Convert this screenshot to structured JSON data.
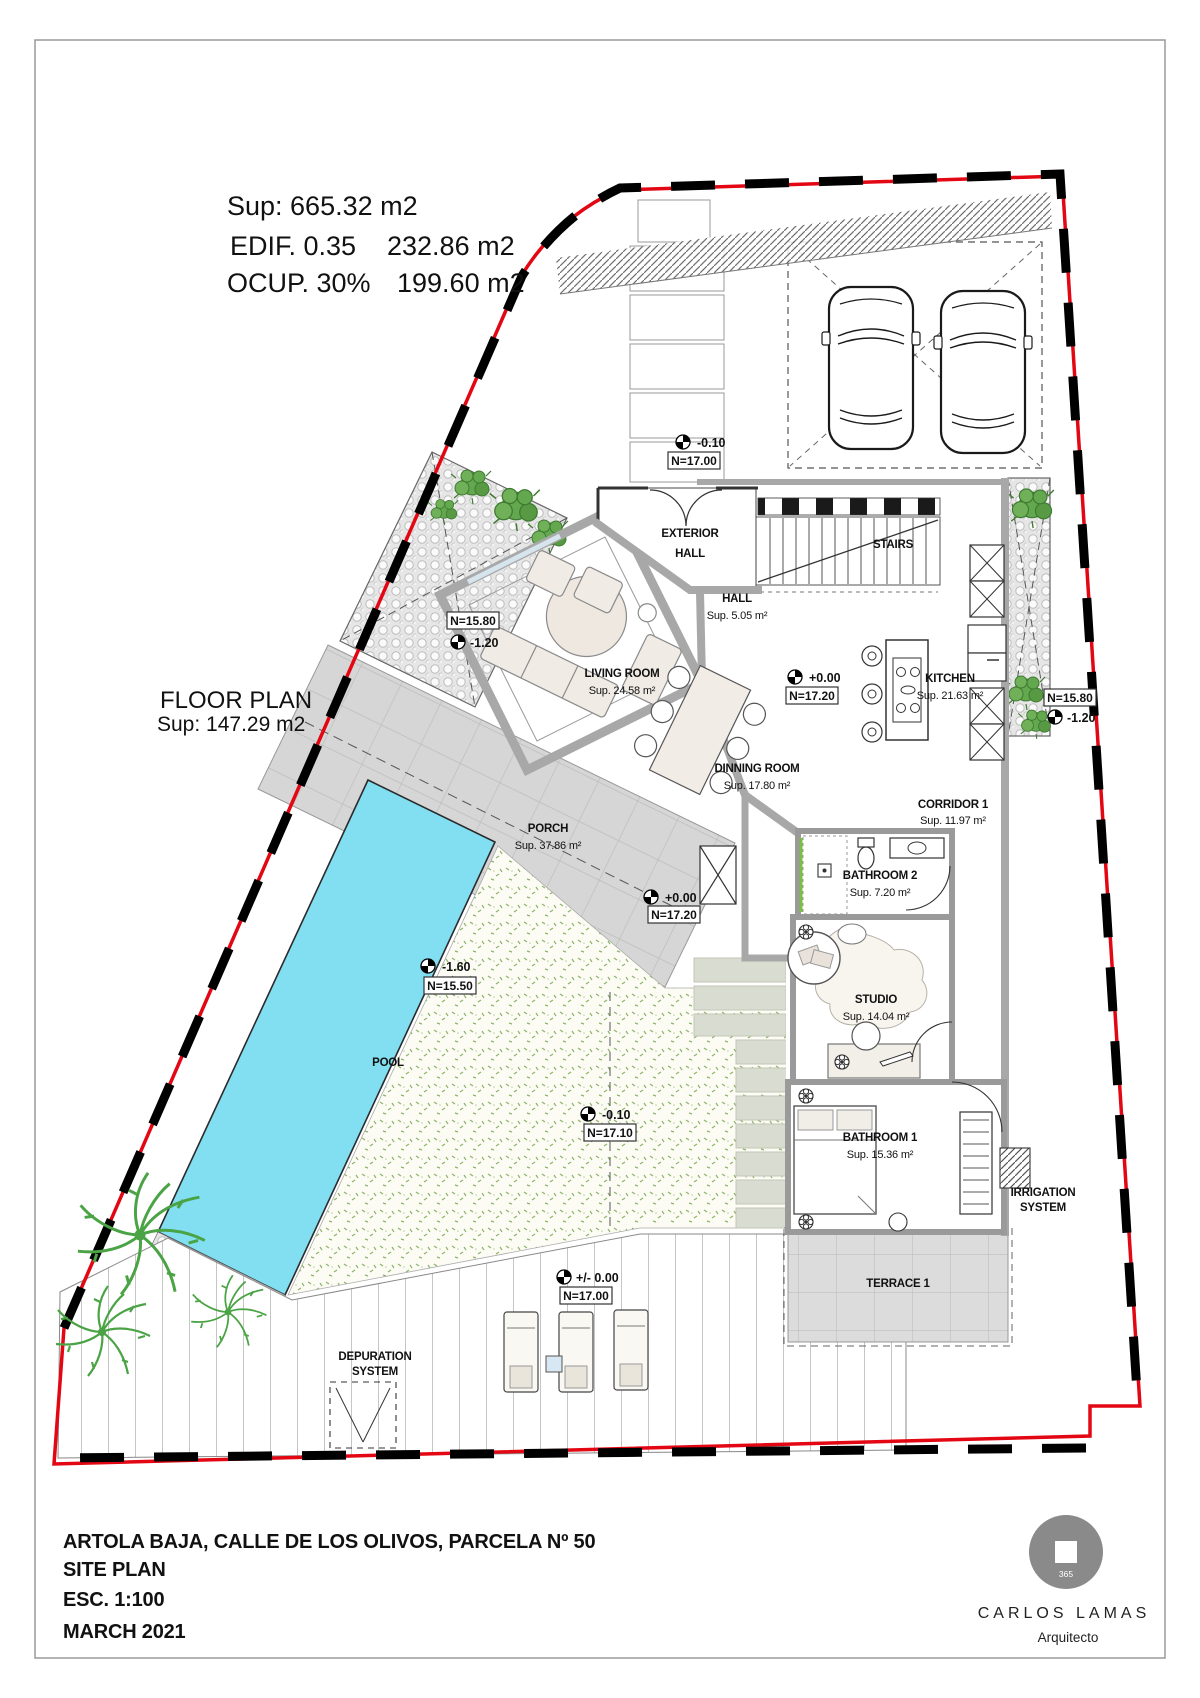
{
  "summary": {
    "sup": "Sup: 665.32 m2",
    "edif_label": "EDIF. 0.35",
    "edif_value": "232.86 m2",
    "ocup_label": "OCUP. 30%",
    "ocup_value": "199.60 m2"
  },
  "floor_plan": {
    "title": "FLOOR PLAN",
    "area": "Sup: 147.29 m2"
  },
  "rooms": [
    {
      "name": "HALL",
      "area": "Sup. 5.05 m²"
    },
    {
      "name": "LIVING ROOM",
      "area": "Sup. 24.58 m²"
    },
    {
      "name": "KITCHEN",
      "area": "Sup. 21.63 m²"
    },
    {
      "name": "DINNING ROOM",
      "area": "Sup. 17.80 m²"
    },
    {
      "name": "CORRIDOR 1",
      "area": "Sup. 11.97 m²"
    },
    {
      "name": "BATHROOM 2",
      "area": "Sup. 7.20 m²"
    },
    {
      "name": "STUDIO",
      "area": "Sup. 14.04 m²"
    },
    {
      "name": "BATHROOM 1",
      "area": "Sup. 15.36 m²"
    },
    {
      "name": "PORCH",
      "area": "Sup. 37.86 m²"
    }
  ],
  "areas": {
    "exterior_hall_1": "EXTERIOR",
    "exterior_hall_2": "HALL",
    "stairs": "STAIRS",
    "pool": "POOL",
    "terrace": "TERRACE 1",
    "depuration_1": "DEPURATION",
    "depuration_2": "SYSTEM",
    "irrigation_1": "IRRIGATION",
    "irrigation_2": "SYSTEM"
  },
  "levels": [
    {
      "value": "-0.10",
      "n": "N=17.00"
    },
    {
      "value": "+0.00",
      "n": "N=17.20"
    },
    {
      "value": "-1.20",
      "n": "N=15.80"
    },
    {
      "value": "-1.20",
      "n": "N=15.80"
    },
    {
      "value": "+0.00",
      "n": "N=17.20"
    },
    {
      "value": "-1.60",
      "n": "N=15.50"
    },
    {
      "value": "-0.10",
      "n": "N=17.10"
    },
    {
      "value": "+/- 0.00",
      "n": "N=17.00"
    }
  ],
  "title_block": {
    "address": "ARTOLA BAJA, CALLE DE LOS OLIVOS, PARCELA Nº 50",
    "plan": "SITE PLAN",
    "scale": "ESC. 1:100",
    "date": "MARCH 2021"
  },
  "logo": {
    "badge": "365",
    "name": "CARLOS LAMAS",
    "role": "Arquitecto"
  },
  "colors": {
    "boundary_red": "#e30613",
    "pool_blue": "#82dff2",
    "wall_gray": "#a8a8a8",
    "vegetation_green": "#4e9a3e"
  }
}
